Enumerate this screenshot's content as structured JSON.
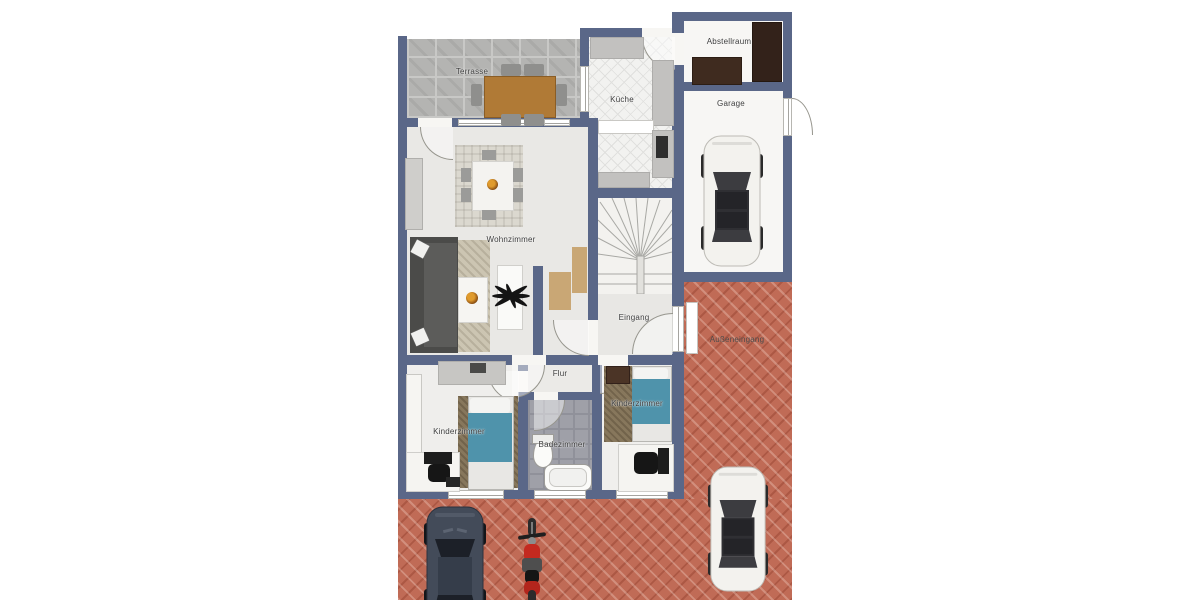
{
  "floorplan": {
    "title": "Grundriss Erdgeschoss",
    "rooms": [
      {
        "id": "terrasse",
        "label": "Terrasse"
      },
      {
        "id": "kueche",
        "label": "Küche"
      },
      {
        "id": "abstellraum",
        "label": "Abstellraum"
      },
      {
        "id": "garage",
        "label": "Garage"
      },
      {
        "id": "wohnzimmer",
        "label": "Wohnzimmer"
      },
      {
        "id": "eingang",
        "label": "Eingang"
      },
      {
        "id": "aussen-eingang",
        "label": "Außeneingang"
      },
      {
        "id": "flur",
        "label": "Flur"
      },
      {
        "id": "kinderzimmer-links",
        "label": "Kinderzimmer"
      },
      {
        "id": "badezimmer",
        "label": "Badezimmer"
      },
      {
        "id": "kinderzimmer-rechts",
        "label": "Kinderzimmer"
      }
    ],
    "colors": {
      "wall": "#5a6788",
      "brick_paving": "#c06b56",
      "terrace_tile": "#b4b4b2",
      "bathroom_tile": "#9fa0a8",
      "kitchen_tile": "#f2f2f0",
      "bed_blanket_blue": "#4f93ab",
      "wood_table_brown": "#b07a36",
      "dark_furniture_brown": "#3f2b1f",
      "sofa_gray": "#4b4b49",
      "car_white": "#f3f2ee",
      "car_dark": "#434b59",
      "motorcycle_red": "#c4291f"
    },
    "icons": {
      "staircase": "winder-stair-fan",
      "garage_vehicle": "car-top-view-white",
      "driveway_vehicle_1": "car-top-view-dark",
      "driveway_vehicle_2": "motorcycle-top-view-red",
      "driveway_vehicle_3": "car-top-view-white",
      "plants": "potted-plant-dot",
      "tv_fan": "black-fan-decor"
    }
  }
}
